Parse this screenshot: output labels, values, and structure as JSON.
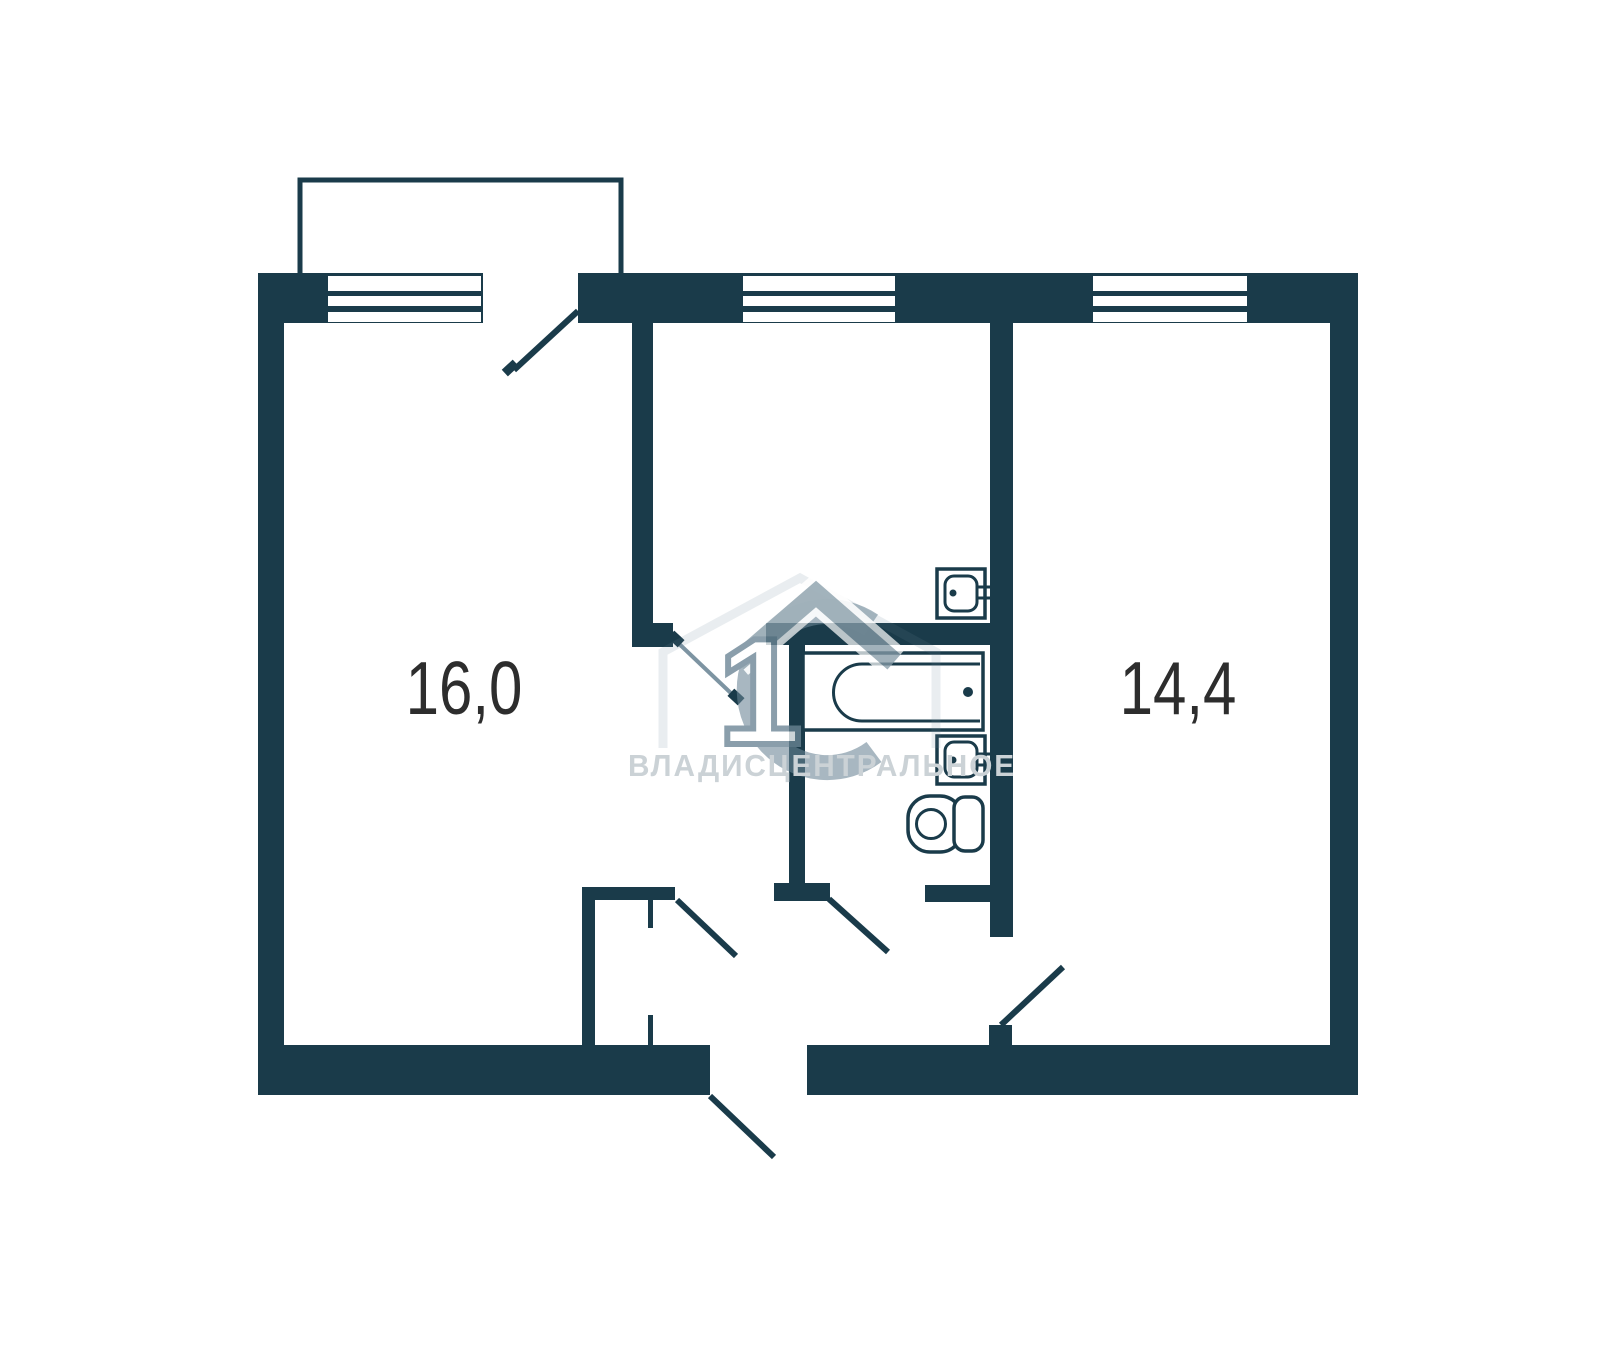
{
  "plan": {
    "type": "apartment-floor-plan",
    "rooms": [
      {
        "name": "left-room",
        "area_label": "16,0"
      },
      {
        "name": "right-room",
        "area_label": "14,4"
      }
    ],
    "fixtures": [
      "bathtub",
      "kitchen-sink",
      "bathroom-sink",
      "toilet"
    ],
    "features": {
      "windows": 3,
      "door_swings": 6,
      "balcony": true,
      "closet": true
    },
    "watermark": {
      "text": "ВЛАДИСЦЕНТРАЛЬНОЕ",
      "logo": "house-circle-1-emblem",
      "logo_digit": "1"
    },
    "colors": {
      "background": "#ffffff",
      "wall": "#1a3b4a",
      "room_label": "#2d2d2d",
      "watermark_gray": "#6a8494",
      "watermark_text": "#cbd2d6"
    }
  }
}
